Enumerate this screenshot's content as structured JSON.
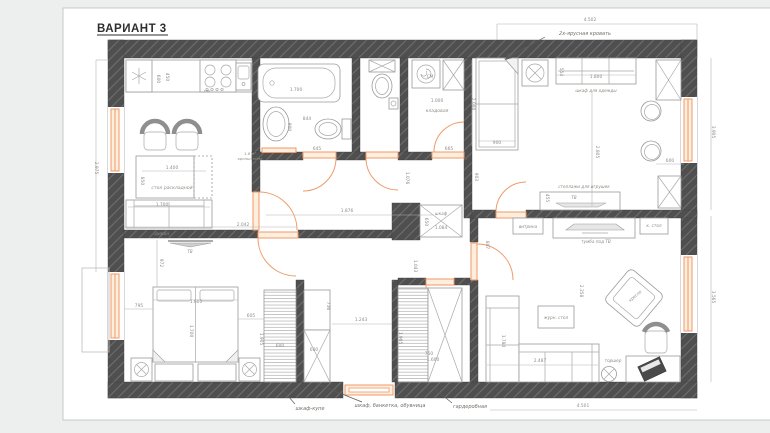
{
  "window": {
    "title": "ВАРИАНТ 3"
  },
  "colors": {
    "wall": "#4f4f4f",
    "wall_hatch": "#6e6e6e",
    "accent_orange": "#ef9a67",
    "dim_text": "#8d8d8d",
    "label_text": "#8b8b82",
    "page_bg": "#ffffff",
    "canvas_bg": "#edefee"
  },
  "plan": {
    "room_labels": [
      {
        "name": "kitchen-table-label",
        "text": "стол раскладной",
        "x": 172,
        "y": 189
      },
      {
        "name": "kitchen-sofa-label",
        "text": "диван",
        "x": 162,
        "y": 235
      },
      {
        "name": "kitchen-tv-label",
        "text": "ТВ",
        "x": 190,
        "y": 253,
        "size": 4
      },
      {
        "name": "microwave-label",
        "text": "свч",
        "x": 207,
        "y": 92,
        "size": 3.8
      },
      {
        "name": "towel-note-line-1",
        "text": "1.8 м²",
        "x": 250,
        "y": 155,
        "size": 3.8
      },
      {
        "name": "towel-note-line-2",
        "text": "кронштейна",
        "x": 250,
        "y": 160,
        "size": 3.8
      },
      {
        "name": "washing-machine-label",
        "text": "СМ",
        "x": 430,
        "y": 78,
        "size": 4.2
      },
      {
        "name": "storage-room-label",
        "text": "кладовая",
        "x": 437,
        "y": 112
      },
      {
        "name": "bunk-bed-callout",
        "text": "2х-ярусная кровать",
        "x": 585,
        "y": 35,
        "size": 5
      },
      {
        "name": "kids-wardrobe-label",
        "text": "шкаф для одежды",
        "x": 596,
        "y": 92,
        "size": 4.2
      },
      {
        "name": "toy-shelves-label",
        "text": "стеллажи для игрушек",
        "x": 584,
        "y": 188,
        "size": 4.2
      },
      {
        "name": "kids-tv-label",
        "text": "ТВ",
        "x": 574,
        "y": 199,
        "size": 4
      },
      {
        "name": "vitrine-label",
        "text": "витрина",
        "x": 528,
        "y": 228,
        "size": 4.2
      },
      {
        "name": "tv-stand-label",
        "text": "тумба под ТВ",
        "x": 596,
        "y": 243,
        "size": 4.2
      },
      {
        "name": "side-table-label",
        "text": "к. стол",
        "x": 654,
        "y": 227,
        "size": 4.2
      },
      {
        "name": "coffee-table-label",
        "text": "журн. стол",
        "x": 556,
        "y": 319,
        "size": 4.2
      },
      {
        "name": "armchair-label",
        "text": "кресло",
        "x": 636,
        "y": 297,
        "rot": -40,
        "size": 4.2
      },
      {
        "name": "floor-lamp-label",
        "text": "торшер",
        "x": 613,
        "y": 362,
        "size": 4.2
      },
      {
        "name": "hall-wardrobe-label",
        "text": "шкаф",
        "x": 441,
        "y": 215,
        "size": 4.2
      },
      {
        "name": "wardrobe-kupe-callout",
        "text": "шкаф-купе",
        "x": 310,
        "y": 410
      },
      {
        "name": "entry-wardrobe-callout",
        "text": "шкаф, банкетка, обувница",
        "x": 390,
        "y": 407
      },
      {
        "name": "walk-in-closet-callout",
        "text": "гардеробная",
        "x": 470,
        "y": 408
      }
    ],
    "dimensions": [
      {
        "text": "4.502",
        "x": 590,
        "y": 21
      },
      {
        "text": "4.501",
        "x": 583,
        "y": 407
      },
      {
        "text": "3.905",
        "x": 712,
        "y": 132,
        "rot": 90
      },
      {
        "text": "3.565",
        "x": 712,
        "y": 297,
        "rot": 90
      },
      {
        "text": "2.975",
        "x": 95,
        "y": 168,
        "rot": 90
      },
      {
        "text": "600",
        "x": 157,
        "y": 79,
        "rot": 90
      },
      {
        "text": "450",
        "x": 166,
        "y": 77,
        "rot": 90
      },
      {
        "text": "1.400",
        "x": 172,
        "y": 169
      },
      {
        "text": "850",
        "x": 141,
        "y": 181,
        "rot": 90
      },
      {
        "text": "1.700",
        "x": 162,
        "y": 206
      },
      {
        "text": "2.042",
        "x": 243,
        "y": 226
      },
      {
        "text": "1.700",
        "x": 296,
        "y": 91
      },
      {
        "text": "900",
        "x": 288,
        "y": 127,
        "rot": 90
      },
      {
        "text": "844",
        "x": 307,
        "y": 120
      },
      {
        "text": "645",
        "x": 317,
        "y": 150
      },
      {
        "text": "665",
        "x": 449,
        "y": 150
      },
      {
        "text": "1.000",
        "x": 437,
        "y": 102
      },
      {
        "text": "903",
        "x": 475,
        "y": 177,
        "rot": 90
      },
      {
        "text": "1.076",
        "x": 406,
        "y": 178,
        "rot": 90
      },
      {
        "text": "1.876",
        "x": 347,
        "y": 212
      },
      {
        "text": "807",
        "x": 486,
        "y": 245,
        "rot": 90
      },
      {
        "text": "1.043",
        "x": 414,
        "y": 266,
        "rot": 90
      },
      {
        "text": "1.084",
        "x": 441,
        "y": 229
      },
      {
        "text": "650",
        "x": 425,
        "y": 222,
        "rot": 90
      },
      {
        "text": "2.000",
        "x": 472,
        "y": 104,
        "rot": 90
      },
      {
        "text": "900",
        "x": 497,
        "y": 144
      },
      {
        "text": "554",
        "x": 560,
        "y": 72,
        "rot": 90
      },
      {
        "text": "1.800",
        "x": 596,
        "y": 78
      },
      {
        "text": "2.805",
        "x": 596,
        "y": 152,
        "rot": 90
      },
      {
        "text": "600",
        "x": 670,
        "y": 162
      },
      {
        "text": "455",
        "x": 546,
        "y": 198,
        "rot": 90
      },
      {
        "text": "972",
        "x": 160,
        "y": 263,
        "rot": 90
      },
      {
        "text": "795",
        "x": 139,
        "y": 307
      },
      {
        "text": "1.600",
        "x": 196,
        "y": 303
      },
      {
        "text": "1.700",
        "x": 190,
        "y": 331,
        "rot": 90
      },
      {
        "text": "605",
        "x": 251,
        "y": 317
      },
      {
        "text": "1.905",
        "x": 260,
        "y": 339,
        "rot": 90
      },
      {
        "text": "600",
        "x": 280,
        "y": 347
      },
      {
        "text": "736",
        "x": 327,
        "y": 306,
        "rot": 90
      },
      {
        "text": "600",
        "x": 314,
        "y": 351
      },
      {
        "text": "1.243",
        "x": 361,
        "y": 321
      },
      {
        "text": "1.905",
        "x": 399,
        "y": 338,
        "rot": 90
      },
      {
        "text": "750",
        "x": 429,
        "y": 355
      },
      {
        "text": "1.600",
        "x": 433,
        "y": 361
      },
      {
        "text": "2.487",
        "x": 540,
        "y": 362
      },
      {
        "text": "2.358",
        "x": 580,
        "y": 291,
        "rot": 90
      },
      {
        "text": "1.780",
        "x": 502,
        "y": 341,
        "rot": 90
      }
    ]
  }
}
